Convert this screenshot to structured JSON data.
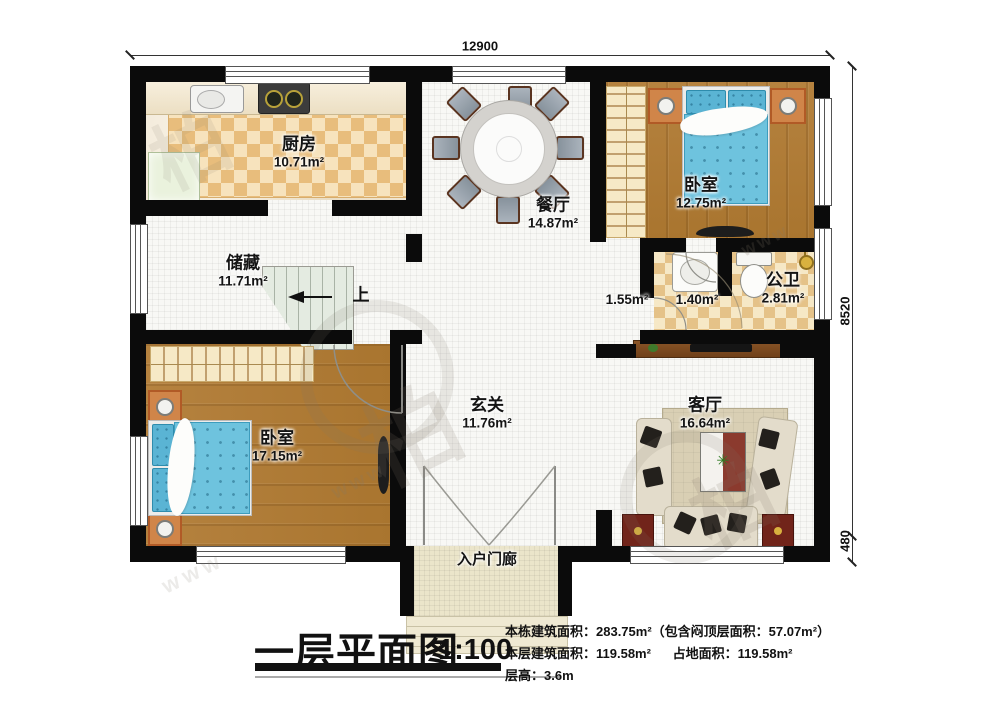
{
  "dimensions": {
    "width_top": "12900",
    "height_main": "8520",
    "height_step": "480"
  },
  "rooms": {
    "kitchen": {
      "name": "厨房",
      "area": "10.71m²"
    },
    "dining": {
      "name": "餐厅",
      "area": "14.87m²"
    },
    "bedroom1": {
      "name": "卧室",
      "area": "12.75m²"
    },
    "storage": {
      "name": "储藏",
      "area": "11.71m²"
    },
    "corridor": {
      "area": "1.55m²"
    },
    "washroom": {
      "area": "1.40m²"
    },
    "bathroom": {
      "name": "公卫",
      "area": "2.81m²"
    },
    "bedroom2": {
      "name": "卧室",
      "area": "17.15m²"
    },
    "hall": {
      "name": "玄关",
      "area": "11.76m²"
    },
    "living": {
      "name": "客厅",
      "area": "16.64m²"
    },
    "porch": {
      "name": "入户门廊"
    }
  },
  "stairs": {
    "up_label": "上"
  },
  "title_block": {
    "title": "一层平面图",
    "scale": "1:100",
    "building_area_line": "本栋建筑面积：283.75m²（包含闷顶层面积：57.07m²）",
    "floor_area": "本层建筑面积：119.58m²",
    "footprint_area": "占地面积：119.58m²",
    "floor_height": "层高：3.6m"
  },
  "watermark": {
    "logo_char": "柏",
    "web_text": "www"
  },
  "colors": {
    "wall": "#0b0b0b",
    "wood": "#b07c36",
    "bed_blue": "#6ec3de",
    "checker": "#e8bd7c"
  }
}
